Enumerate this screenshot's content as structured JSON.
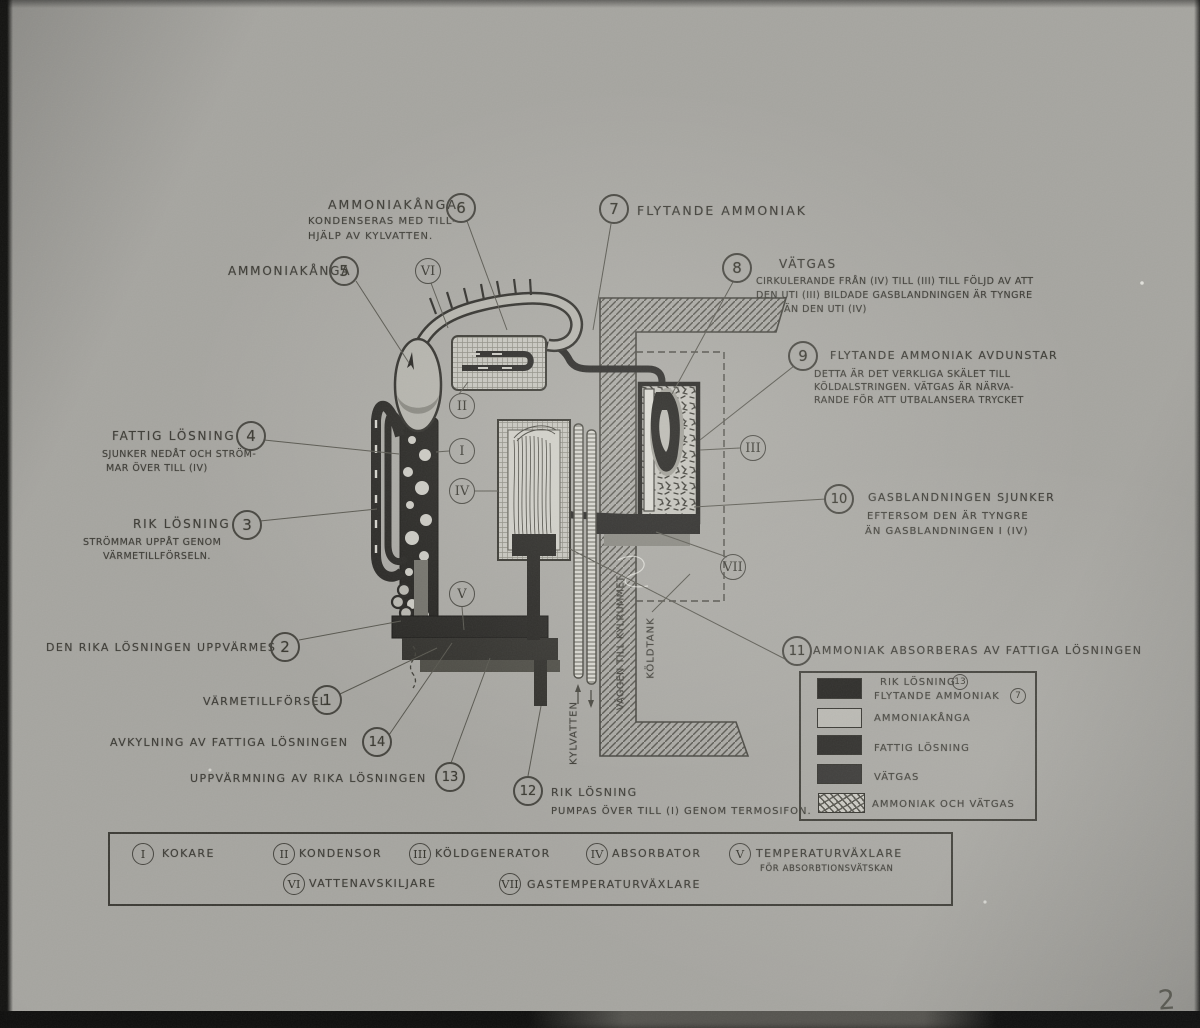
{
  "palette": {
    "ink": "#3d3c36",
    "photo_bg": "#a6a5a0"
  },
  "photo": {
    "corner_number": "2"
  },
  "labels": {
    "n1": {
      "num": "1",
      "title": "VÄRMETILLFÖRSEL"
    },
    "n2": {
      "num": "2",
      "title": "DEN RIKA LÖSNINGEN UPPVÄRMES"
    },
    "n3": {
      "num": "3",
      "title": "RIK LÖSNING",
      "sub1": "STRÖMMAR UPPÅT GENOM",
      "sub2": "VÄRMETILLFÖRSELN."
    },
    "n4": {
      "num": "4",
      "title": "FATTIG LÖSNING",
      "sub1": "SJUNKER NEDÅT OCH STRÖM-",
      "sub2": "MAR ÖVER TILL (IV)"
    },
    "n5": {
      "num": "5",
      "title": "AMMONIAKÅNGA"
    },
    "n6": {
      "num": "6",
      "title": "AMMONIAKÅNGA",
      "sub1": "KONDENSERAS MED TILL-",
      "sub2": "HJÄLP AV KYLVATTEN."
    },
    "n7": {
      "num": "7",
      "title": "FLYTANDE AMMONIAK"
    },
    "n8": {
      "num": "8",
      "title": "VÄTGAS",
      "sub1": "CIRKULERANDE FRÅN (IV) TILL (III) TILL FÖLJD AV ATT",
      "sub2": "DEN UTI (III) BILDADE GASBLANDNINGEN ÄR TYNGRE",
      "sub3": "ÄN DEN UTI (IV)"
    },
    "n9": {
      "num": "9",
      "title": "FLYTANDE AMMONIAK AVDUNSTAR",
      "sub1": "DETTA ÄR DET VERKLIGA SKÄLET TILL",
      "sub2": "KÖLDALSTRINGEN. VÄTGAS ÄR NÄRVA-",
      "sub3": "RANDE FÖR ATT UTBALANSERA TRYCKET"
    },
    "n10": {
      "num": "10",
      "title": "GASBLANDNINGEN SJUNKER",
      "sub1": "EFTERSOM DEN ÄR TYNGRE",
      "sub2": "ÄN GASBLANDNINGEN I (IV)"
    },
    "n11": {
      "num": "11",
      "title": "AMMONIAK ABSORBERAS AV FATTIGA LÖSNINGEN"
    },
    "n12": {
      "num": "12",
      "title": "RIK LÖSNING",
      "sub1": "PUMPAS ÖVER TILL (I) GENOM TERMOSIFON."
    },
    "n13": {
      "num": "13",
      "title": "UPPVÄRMNING AV RIKA LÖSNINGEN"
    },
    "n14": {
      "num": "14",
      "title": "AVKYLNING AV FATTIGA LÖSNINGEN"
    }
  },
  "diagram_marks": {
    "r1": "I",
    "r2": "II",
    "r3": "III",
    "r4": "IV",
    "r5": "V",
    "r6": "VI",
    "r7": "VII",
    "kylvatten": "KYLVATTEN",
    "vaggen": "VÄGGEN TILL KYLRUMMET",
    "koldtank": "KÖLDTANK"
  },
  "color_legend": {
    "rows": [
      {
        "label": "RIK LÖSNING",
        "ref": "13",
        "label2": "FLYTANDE AMMONIAK",
        "ref2": "7",
        "swatch": "#1d1c19"
      },
      {
        "label": "AMMONIAKÅNGA",
        "swatch": "#b6b5af"
      },
      {
        "label": "FATTIG LÖSNING",
        "swatch": "#262522"
      },
      {
        "label": "VÄTGAS",
        "swatch": "#333230"
      },
      {
        "label": "AMMONIAK OCH VÄTGAS",
        "swatch": "stipple"
      }
    ]
  },
  "component_legend": {
    "items": [
      {
        "numeral": "I",
        "name": "KOKARE"
      },
      {
        "numeral": "II",
        "name": "KONDENSOR"
      },
      {
        "numeral": "III",
        "name": "KÖLDGENERATOR"
      },
      {
        "numeral": "IV",
        "name": "ABSORBATOR"
      },
      {
        "numeral": "V",
        "name": "TEMPERATURVÄXLARE",
        "sub": "FÖR ABSORBTIONSVÄTSKAN"
      },
      {
        "numeral": "VI",
        "name": "VATTENAVSKILJARE"
      },
      {
        "numeral": "VII",
        "name": "GASTEMPERATURVÄXLARE"
      }
    ]
  }
}
